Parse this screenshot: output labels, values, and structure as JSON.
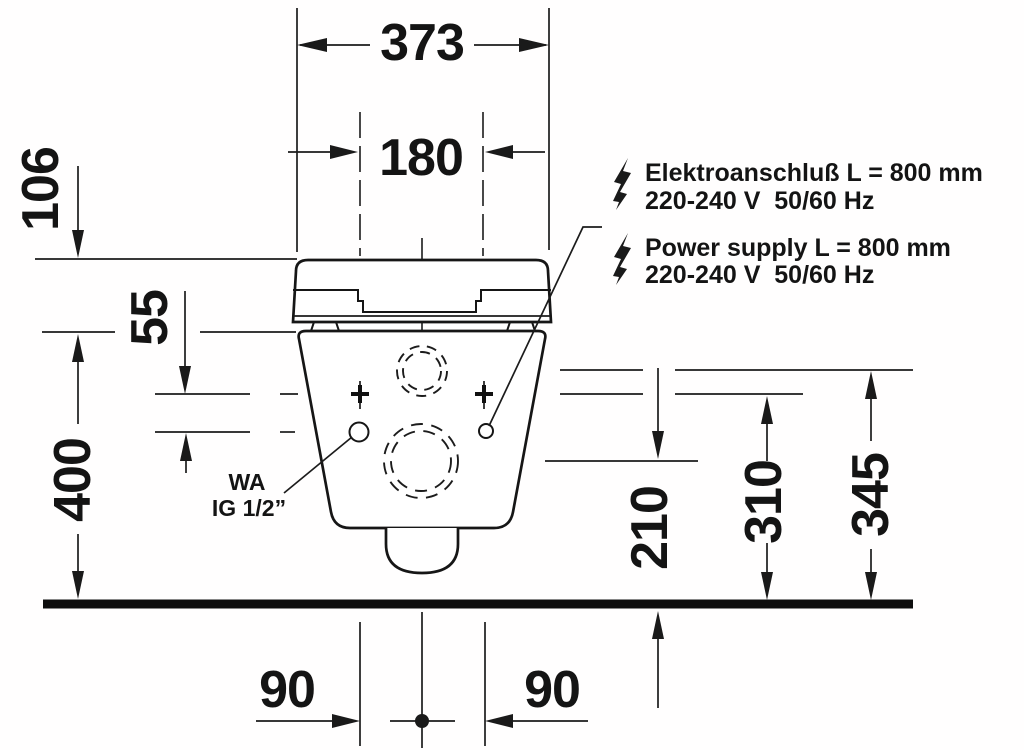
{
  "drawing": {
    "dimensions": {
      "overall_width": "373",
      "connection_spacing": "180",
      "lid_offset": "106",
      "connection_drop": "55",
      "rim_height": "400",
      "outlet_height": "210",
      "fixing_height": "310",
      "inlet_height": "345",
      "left_offset": "90",
      "right_offset": "90"
    },
    "water_connection": {
      "line1": "WA",
      "line2": "IG 1/2”"
    },
    "electrical": {
      "de_line1": "Elektroanschluß L = 800 mm",
      "de_line2": "220-240 V  50/60 Hz",
      "en_line1": "Power supply L = 800 mm",
      "en_line2": "220-240 V  50/60 Hz"
    },
    "colors": {
      "line": "#1c1c1c",
      "background": "#ffffff"
    }
  }
}
